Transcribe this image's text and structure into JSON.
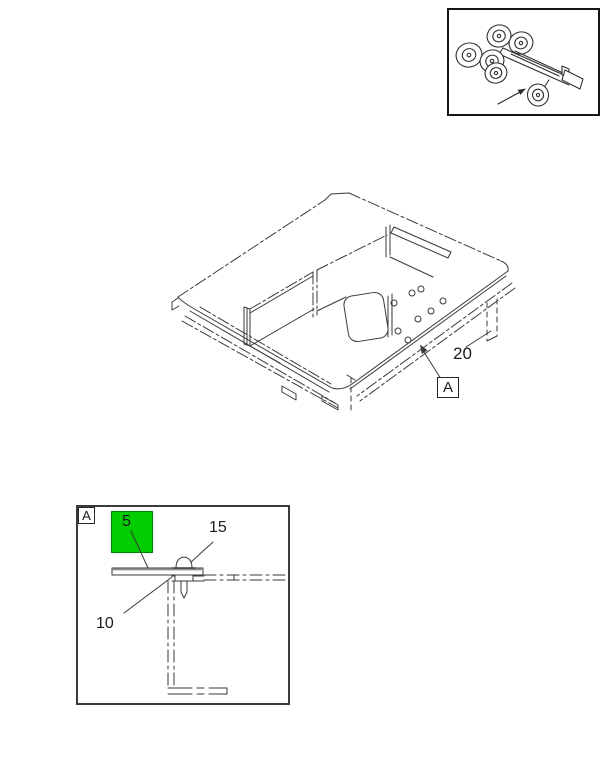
{
  "page": {
    "background": "#ffffff",
    "line_color": "#3a3a3a"
  },
  "locator_inset": {
    "icon": "truck-chassis-icon",
    "pointer": "arrow-to-chassis"
  },
  "main_view": {
    "callout_20": {
      "label": "20"
    },
    "view_flag_a": {
      "label": "A"
    }
  },
  "detail_view": {
    "frame_flag": {
      "label": "A"
    },
    "highlight": {
      "label": "5",
      "color": "#00cc00"
    },
    "callout_15": {
      "label": "15"
    },
    "callout_10": {
      "label": "10"
    }
  }
}
